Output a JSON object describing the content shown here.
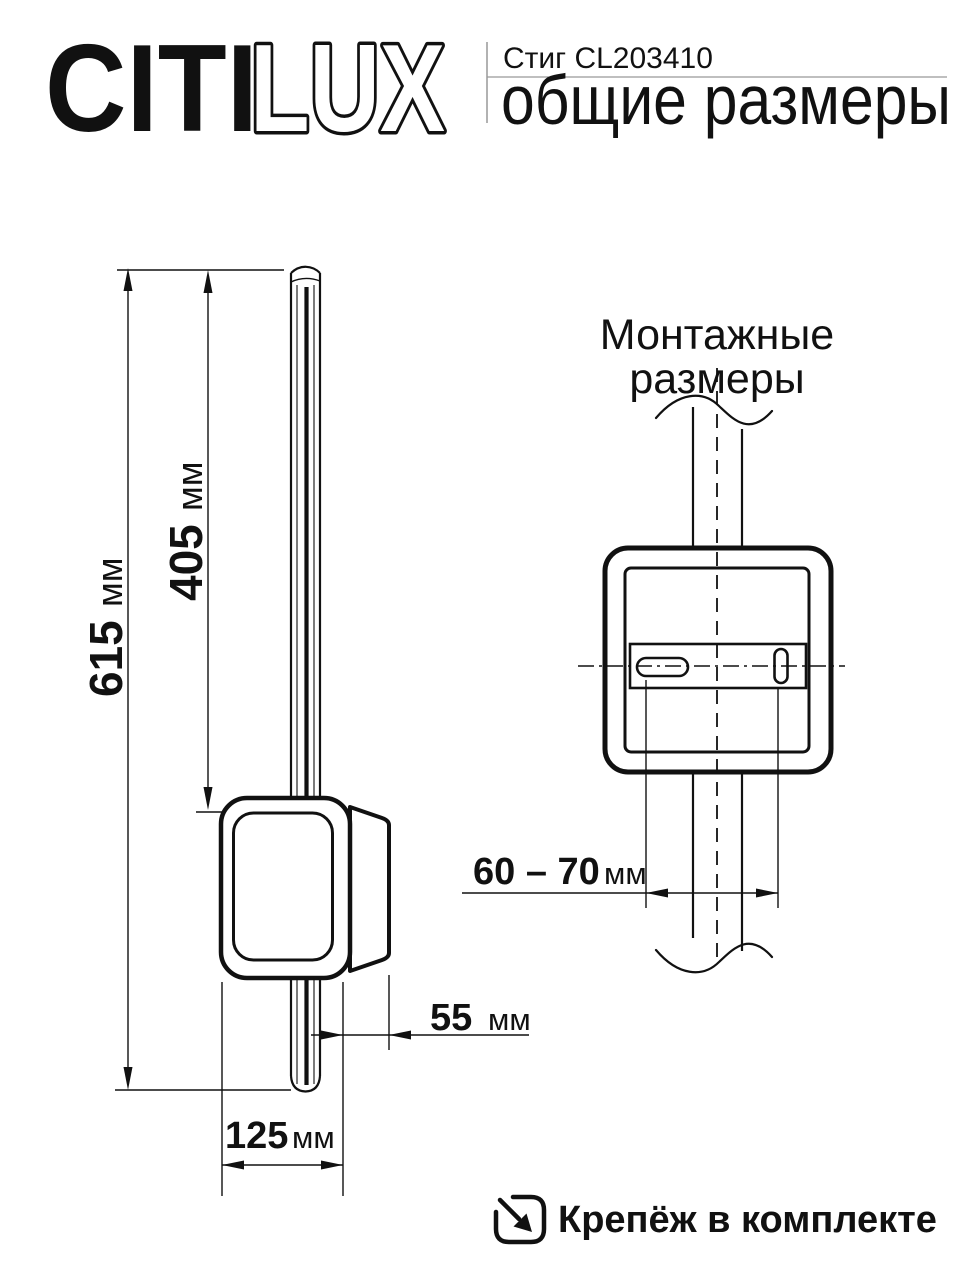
{
  "header": {
    "logo_part_solid": "CITI",
    "logo_part_outline": "LUX",
    "product_name": "Стиг CL203410",
    "subtitle": "общие размеры"
  },
  "overall_view": {
    "dim_total_height": {
      "value": "615",
      "unit": "мм"
    },
    "dim_rod_height": {
      "value": "405",
      "unit": "мм"
    },
    "dim_depth": {
      "value": "55",
      "unit": "мм"
    },
    "dim_width": {
      "value": "125",
      "unit": "мм"
    }
  },
  "mounting_view": {
    "title_line1": "Монтажные",
    "title_line2": "размеры",
    "dim_mounting_range": {
      "value": "60 – 70",
      "unit": "мм"
    }
  },
  "footer": {
    "hardware_note": "Крепёж в комплекте"
  },
  "colors": {
    "ink": "#111111",
    "divider_gray": "#999999",
    "background": "#ffffff"
  }
}
